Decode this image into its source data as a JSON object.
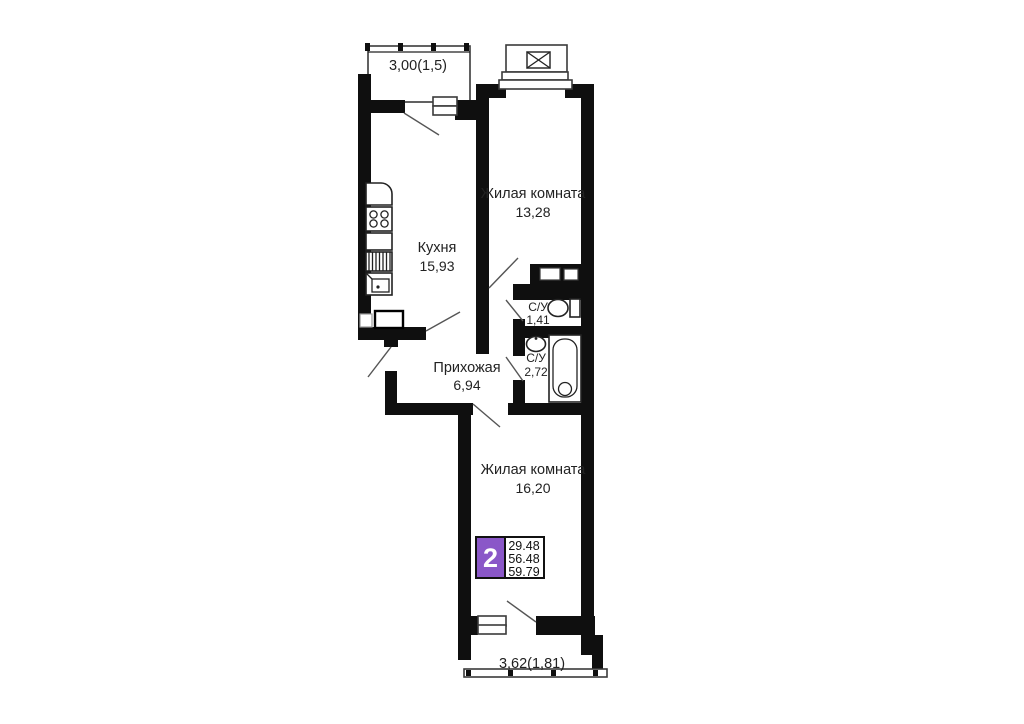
{
  "colors": {
    "wall": "#0f0f0f",
    "accent_purple": "#8a57c8",
    "text": "#222222"
  },
  "rooms": {
    "balcony_top": {
      "label": "3,00(1,5)"
    },
    "kitchen": {
      "name": "Кухня",
      "area": "15,93"
    },
    "living_room_top": {
      "name": "Жилая комната",
      "area": "13,28"
    },
    "wc_small": {
      "name": "С/У",
      "area": "1,41"
    },
    "bathroom": {
      "name": "С/У",
      "area": "2,72"
    },
    "hallway": {
      "name": "Прихожая",
      "area": "6,94"
    },
    "living_room_bottom": {
      "name": "Жилая комната",
      "area": "16,20"
    },
    "balcony_bottom": {
      "label": "3,62(1,81)"
    }
  },
  "badge": {
    "rooms_count": "2",
    "living_area": "29.48",
    "apartment_area": "56.48",
    "total_area": "59.79"
  }
}
